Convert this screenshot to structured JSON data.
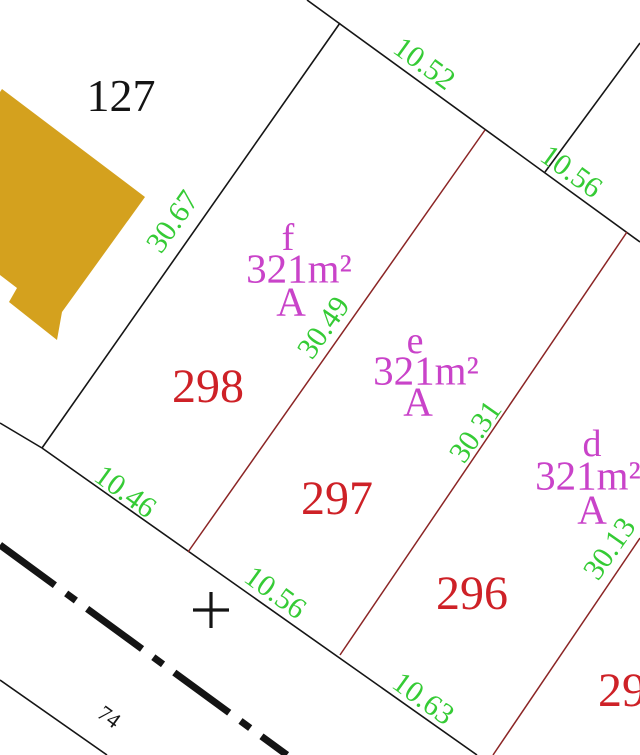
{
  "map_type": "cadastral-parcel-map",
  "colors": {
    "background": "#ffffff",
    "boundary_black": "#151515",
    "boundary_red": "#8B2525",
    "parcel_number_red": "#CE2127",
    "dimension_green": "#35CB35",
    "area_label_magenta": "#C943C9",
    "building_fill_gold": "#D4A11E",
    "black_text": "#141414"
  },
  "parcel_numbers": [
    {
      "label": "127"
    },
    {
      "label": "298"
    },
    {
      "label": "297"
    },
    {
      "label": "296"
    },
    {
      "label": "29"
    }
  ],
  "lot_labels": [
    {
      "letter": "f",
      "area": "321m²",
      "zone": "A"
    },
    {
      "letter": "e",
      "area": "321m²",
      "zone": "A"
    },
    {
      "letter": "d",
      "area": "321m²",
      "zone": "A"
    }
  ],
  "dimensions": {
    "top_1052": "10.52",
    "top_1056": "10.56",
    "left_3067": "30.67",
    "mid_3049": "30.49",
    "mid_3031": "30.31",
    "right_3013": "30.13",
    "bottom_1046": "10.46",
    "bottom_1056": "10.56",
    "bottom_1063": "10.63"
  },
  "road": {
    "label": "74"
  },
  "marker": {
    "plus": "+"
  }
}
